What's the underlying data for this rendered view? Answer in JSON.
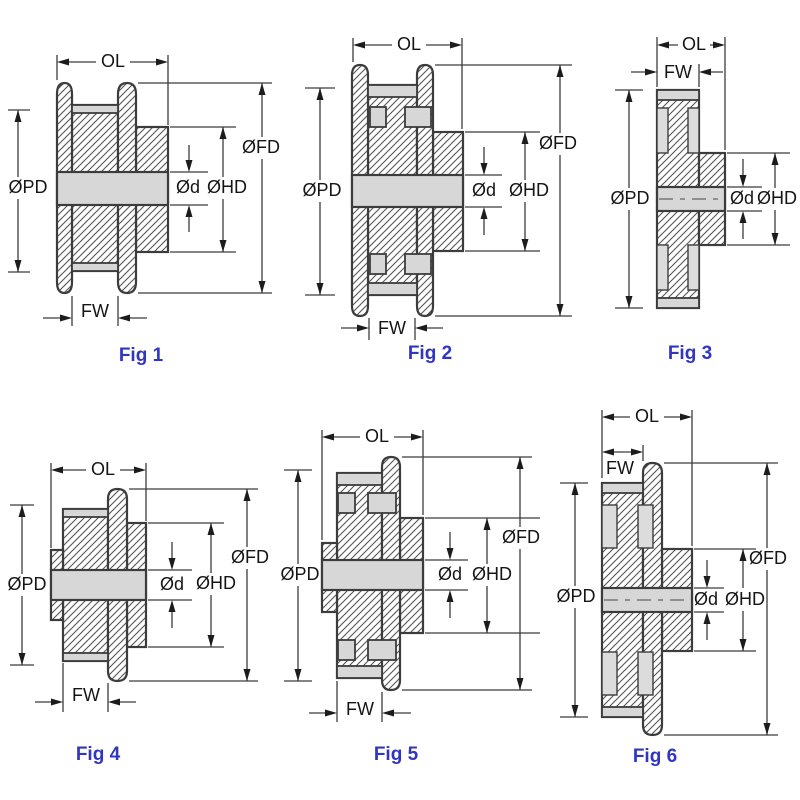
{
  "page": {
    "background": "#ffffff",
    "description": "Six timing-pulley cross-section dimension figures"
  },
  "colors": {
    "outline": "#3c3c3c",
    "hatch_line": "#555555",
    "metal_fill": "#ffffff",
    "gray_fill": "#d7d7d7",
    "dimension_text": "#151515",
    "caption_blue": "#3036c0"
  },
  "figures": [
    {
      "caption": "Fig 1",
      "labels": {
        "ol": "OL",
        "fw": "FW",
        "pd": "ØPD",
        "fd": "ØFD",
        "hd": "ØHD",
        "d": "Ød"
      }
    },
    {
      "caption": "Fig 2",
      "labels": {
        "ol": "OL",
        "fw": "FW",
        "pd": "ØPD",
        "fd": "ØFD",
        "hd": "ØHD",
        "d": "Ød"
      }
    },
    {
      "caption": "Fig 3",
      "labels": {
        "ol": "OL",
        "fw": "FW",
        "pd": "ØPD",
        "hd": "ØHD",
        "d": "Ød"
      }
    },
    {
      "caption": "Fig 4",
      "labels": {
        "ol": "OL",
        "fw": "FW",
        "pd": "ØPD",
        "fd": "ØFD",
        "hd": "ØHD",
        "d": "Ød"
      }
    },
    {
      "caption": "Fig 5",
      "labels": {
        "ol": "OL",
        "fw": "FW",
        "pd": "ØPD",
        "fd": "ØFD",
        "hd": "ØHD",
        "d": "Ød"
      }
    },
    {
      "caption": "Fig 6",
      "labels": {
        "ol": "OL",
        "fw": "FW",
        "pd": "ØPD",
        "fd": "ØFD",
        "hd": "ØHD",
        "d": "Ød"
      }
    }
  ]
}
